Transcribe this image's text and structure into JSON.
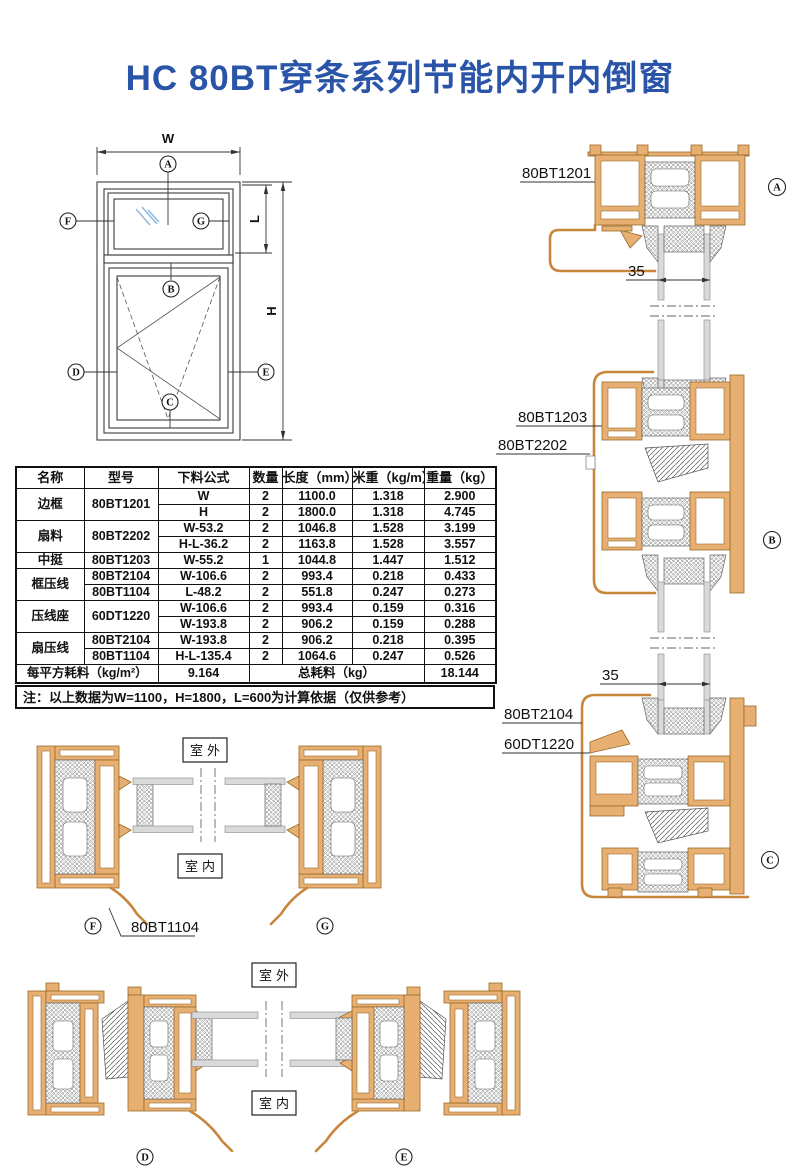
{
  "title": "HC 80BT穿条系列节能内开内倒窗",
  "colors": {
    "title_blue": "#2a54a8",
    "aluminum_fill": "#e7b072",
    "aluminum_stroke": "#9a6a28",
    "trim_stroke": "#c8853c",
    "glass_gray": "#d9d9d9",
    "glass_mark_blue": "#8fb8e0"
  },
  "elevation": {
    "dim_w": "W",
    "dim_h": "H",
    "dim_l": "L",
    "markers": {
      "a": "A",
      "b": "B",
      "c": "C",
      "d": "D",
      "e": "E",
      "f": "F",
      "g": "G"
    }
  },
  "sections_right": {
    "a": {
      "label": "80BT1201",
      "glass_dim": "35",
      "marker": "A"
    },
    "b": {
      "label_1": "80BT1203",
      "label_2": "80BT2202",
      "marker": "B"
    },
    "c": {
      "glass_dim": "35",
      "label_1": "80BT2104",
      "label_2": "60DT1220",
      "marker": "C"
    }
  },
  "section_fg": {
    "outdoor": "室外",
    "indoor": "室内",
    "marker_left": "F",
    "marker_right": "G",
    "label": "80BT1104"
  },
  "section_de": {
    "outdoor": "室外",
    "indoor": "室内",
    "marker_left": "D",
    "marker_right": "E"
  },
  "table": {
    "headers": [
      "名称",
      "型号",
      "下料公式",
      "数量",
      "长度（mm）",
      "米重（kg/m）",
      "重量（kg）"
    ],
    "rows": [
      [
        "边框",
        "80BT1201",
        "W",
        "2",
        "1100.0",
        "1.318",
        "2.900"
      ],
      [
        "",
        "",
        "H",
        "2",
        "1800.0",
        "1.318",
        "4.745"
      ],
      [
        "扇料",
        "80BT2202",
        "W-53.2",
        "2",
        "1046.8",
        "1.528",
        "3.199"
      ],
      [
        "",
        "",
        "H-L-36.2",
        "2",
        "1163.8",
        "1.528",
        "3.557"
      ],
      [
        "中挺",
        "80BT1203",
        "W-55.2",
        "1",
        "1044.8",
        "1.447",
        "1.512"
      ],
      [
        "框压线",
        "80BT2104",
        "W-106.6",
        "2",
        "993.4",
        "0.218",
        "0.433"
      ],
      [
        "",
        "80BT1104",
        "L-48.2",
        "2",
        "551.8",
        "0.247",
        "0.273"
      ],
      [
        "压线座",
        "60DT1220",
        "W-106.6",
        "2",
        "993.4",
        "0.159",
        "0.316"
      ],
      [
        "",
        "",
        "W-193.8",
        "2",
        "906.2",
        "0.159",
        "0.288"
      ],
      [
        "扇压线",
        "80BT2104",
        "W-193.8",
        "2",
        "906.2",
        "0.218",
        "0.395"
      ],
      [
        "",
        "80BT1104",
        "H-L-135.4",
        "2",
        "1064.6",
        "0.247",
        "0.526"
      ]
    ],
    "footer": {
      "per_sqm_label": "每平方耗料（kg/m²）",
      "per_sqm_value": "9.164",
      "total_label": "总耗料（kg）",
      "total_value": "18.144"
    },
    "note": "注：以上数据为W=1100，H=1800，L=600为计算依据（仅供参考）"
  }
}
